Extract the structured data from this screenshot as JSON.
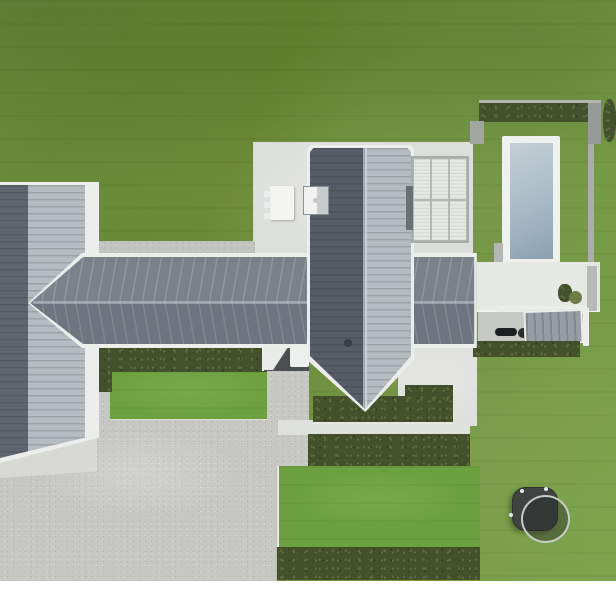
{
  "scene": {
    "type": "aerial-drone-photo",
    "subject": "Top-down view of a modern single-storey house with charcoal standing-seam cross-gable roof, white concrete patios, louvered pergola, fenced swimming pool with hedge enclosure, gravel driveway with square planter boxes, clipped hedge rows, striped lawn and a round trampoline",
    "orientation": "plan view, house centered left, pool top right, driveway bottom left, trampoline bottom right",
    "photo_area": "full width, white margin strip along the bottom edge"
  },
  "regions": [
    "lawn",
    "mowing-stripes",
    "main-roof",
    "west-wing-roof",
    "cross-wing-roof",
    "roof-ridge",
    "chimney-skylight",
    "roof-vent",
    "main-patio",
    "louvered-pergola",
    "outdoor-table",
    "chairs",
    "pool-coping",
    "pool-water",
    "pool-hedge",
    "pool-walls",
    "pool-patio",
    "planter-bushes",
    "outbuilding-roof",
    "bbq-grill",
    "carport-pad",
    "garden-bench",
    "hedge-rows",
    "grass-rectangles",
    "gravel-driveway",
    "concrete-apron",
    "square-planters",
    "trampoline",
    "white-photo-margin"
  ],
  "palette": {
    "grass": "#6f9040",
    "grassLight": "#7ca34b",
    "grassDark": "#64842f",
    "grassRect": "#6da03f",
    "hedge": "#42502c",
    "hedgeLight": "#5a6b3a",
    "roofTop": "#7a818b",
    "roofDark": "#6e7580",
    "roofRibDark": "#5f666f",
    "wingLight": "#b6bbc1",
    "fascia": "#eceeec",
    "concrete": "#dcdedb",
    "gravel": "#c7c8c3",
    "wall": "#a2a6a3",
    "coping": "#eff1ef",
    "poolWater": "#a7bac6",
    "poolWaterLight": "#c4cfd5",
    "shedRoof": "#979ea5",
    "carport": "#4b4f53",
    "trampMat": "#3f4341",
    "trampRing": "#c9cbc6"
  }
}
